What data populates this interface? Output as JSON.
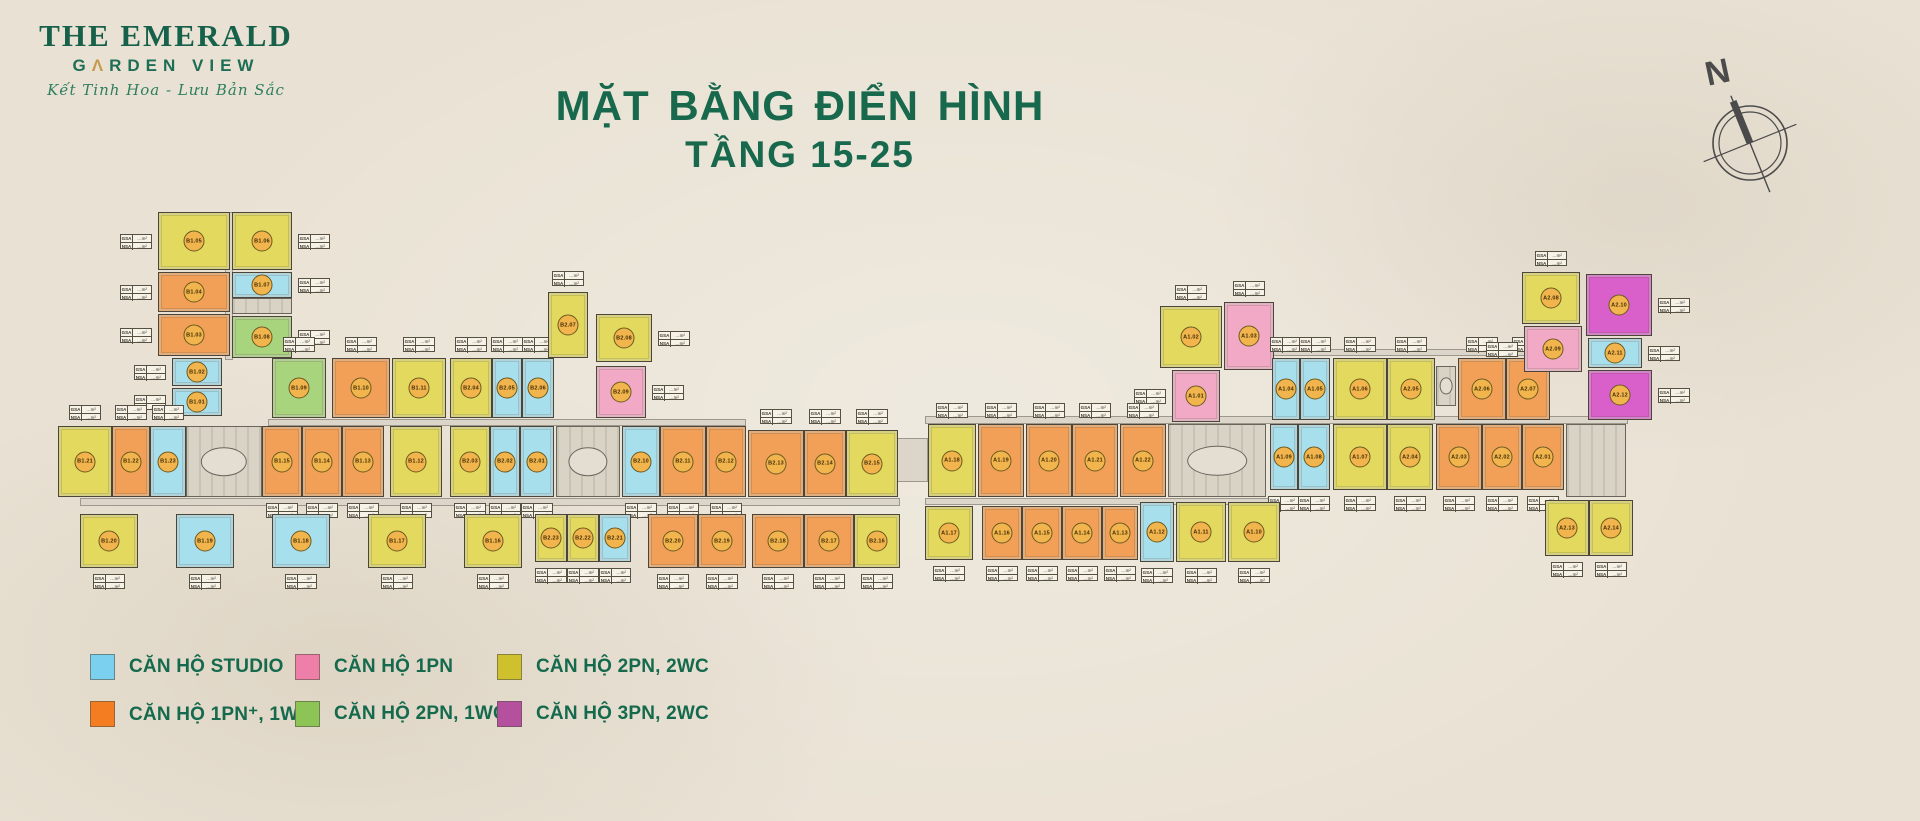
{
  "logo": {
    "line1": "THE EMERALD",
    "line2_prefix": "G",
    "line2_a": "Λ",
    "line2_suffix": "RDEN VIEW",
    "tagline": "Kết Tinh Hoa - Lưu Bản Sắc"
  },
  "title": {
    "line1": "MẶT BẰNG ĐIỂN HÌNH",
    "line2": "TẦNG 15-25"
  },
  "compass": {
    "label": "N"
  },
  "colors": {
    "studio": {
      "unit": "#a7dfed",
      "legend": "#7bd0ef"
    },
    "1pn": {
      "unit": "#f2a9c5",
      "legend": "#ee7fa9"
    },
    "2pn2wc": {
      "unit": "#e2d95e",
      "legend": "#cfc02d"
    },
    "1pn_plus": {
      "unit": "#f2a057",
      "legend": "#f47d21"
    },
    "2pn1wc": {
      "unit": "#a9d47e",
      "legend": "#8cc456"
    },
    "3pn2wc": {
      "unit": "#d95fcb",
      "legend": "#b4509e"
    },
    "accent_green": "#17684c",
    "accent_gold": "#c69b4e"
  },
  "legend": {
    "items": [
      {
        "label": "CĂN HỘ STUDIO",
        "type": "studio"
      },
      {
        "label": "CĂN HỘ 1PN",
        "type": "1pn"
      },
      {
        "label": "CĂN HỘ 2PN, 2WC",
        "type": "2pn2wc"
      },
      {
        "label": "CĂN HỘ 1PN⁺, 1WC",
        "type": "1pn_plus"
      },
      {
        "label": "CĂN HỘ 2PN, 1WC",
        "type": "2pn1wc"
      },
      {
        "label": "CĂN HỘ 3PN, 2WC",
        "type": "3pn2wc"
      }
    ],
    "cols_x": [
      90,
      295,
      497
    ],
    "rows_y": [
      654,
      701
    ]
  },
  "plan": {
    "table_labels": {
      "gsa": "GSA",
      "nsa": "NSA",
      "val": "…m²"
    },
    "corridors": [
      {
        "x": 225,
        "y": 212,
        "w": 8,
        "h": 148
      },
      {
        "x": 268,
        "y": 419,
        "w": 478,
        "h": 7
      },
      {
        "x": 80,
        "y": 498,
        "w": 820,
        "h": 8
      },
      {
        "x": 896,
        "y": 438,
        "w": 32,
        "h": 44
      },
      {
        "x": 925,
        "y": 416,
        "w": 703,
        "h": 8
      },
      {
        "x": 925,
        "y": 498,
        "w": 358,
        "h": 7
      },
      {
        "x": 1272,
        "y": 349,
        "w": 268,
        "h": 7
      }
    ],
    "cores": [
      {
        "x": 232,
        "y": 298,
        "w": 60,
        "h": 16,
        "oval": false
      },
      {
        "x": 186,
        "y": 426,
        "w": 76,
        "h": 71,
        "oval": true
      },
      {
        "x": 556,
        "y": 426,
        "w": 64,
        "h": 71,
        "oval": true
      },
      {
        "x": 1168,
        "y": 424,
        "w": 98,
        "h": 73,
        "oval": true
      },
      {
        "x": 1566,
        "y": 424,
        "w": 60,
        "h": 73,
        "oval": false
      },
      {
        "x": 1436,
        "y": 366,
        "w": 20,
        "h": 40,
        "oval": true
      }
    ],
    "clusters": [
      {
        "name": "block-B1-B2",
        "units": [
          {
            "code": "B1.05",
            "type": "2pn2wc",
            "x": 158,
            "y": 212,
            "w": 72,
            "h": 58,
            "tbl": "left"
          },
          {
            "code": "B1.06",
            "type": "2pn2wc",
            "x": 232,
            "y": 212,
            "w": 60,
            "h": 58,
            "tbl": "right"
          },
          {
            "code": "B1.04",
            "type": "1pn_plus",
            "x": 158,
            "y": 272,
            "w": 72,
            "h": 40,
            "tbl": "left"
          },
          {
            "code": "B1.07",
            "type": "studio",
            "x": 232,
            "y": 272,
            "w": 60,
            "h": 26,
            "tbl": "right"
          },
          {
            "code": "B1.03",
            "type": "1pn_plus",
            "x": 158,
            "y": 314,
            "w": 72,
            "h": 42,
            "tbl": "left"
          },
          {
            "code": "B1.08",
            "type": "2pn1wc",
            "x": 232,
            "y": 316,
            "w": 60,
            "h": 42,
            "tbl": "right"
          },
          {
            "code": "B1.02",
            "type": "studio",
            "x": 172,
            "y": 358,
            "w": 50,
            "h": 28,
            "tbl": "left"
          },
          {
            "code": "B1.01",
            "type": "studio",
            "x": 172,
            "y": 388,
            "w": 50,
            "h": 28,
            "tbl": "left"
          },
          {
            "code": "B1.09",
            "type": "2pn1wc",
            "x": 272,
            "y": 358,
            "w": 54,
            "h": 60,
            "tbl": "above"
          },
          {
            "code": "B1.10",
            "type": "1pn_plus",
            "x": 332,
            "y": 358,
            "w": 58,
            "h": 60,
            "tbl": "above"
          },
          {
            "code": "B1.11",
            "type": "2pn2wc",
            "x": 392,
            "y": 358,
            "w": 54,
            "h": 60,
            "tbl": "above"
          },
          {
            "code": "B2.04",
            "type": "2pn2wc",
            "x": 450,
            "y": 358,
            "w": 42,
            "h": 60,
            "tbl": "above"
          },
          {
            "code": "B2.05",
            "type": "studio",
            "x": 492,
            "y": 358,
            "w": 30,
            "h": 60,
            "tbl": "above"
          },
          {
            "code": "B2.06",
            "type": "studio",
            "x": 522,
            "y": 358,
            "w": 32,
            "h": 60,
            "tbl": "above"
          },
          {
            "code": "B2.07",
            "type": "2pn2wc",
            "x": 548,
            "y": 292,
            "w": 40,
            "h": 66,
            "tbl": "above"
          },
          {
            "code": "B2.08",
            "type": "2pn2wc",
            "x": 596,
            "y": 314,
            "w": 56,
            "h": 48,
            "tbl": "right"
          },
          {
            "code": "B2.09",
            "type": "1pn",
            "x": 596,
            "y": 366,
            "w": 50,
            "h": 52,
            "tbl": "right"
          },
          {
            "code": "B1.21",
            "type": "2pn2wc",
            "x": 58,
            "y": 426,
            "w": 54,
            "h": 71,
            "tbl": "above"
          },
          {
            "code": "B1.22",
            "type": "1pn_plus",
            "x": 112,
            "y": 426,
            "w": 38,
            "h": 71,
            "tbl": "above"
          },
          {
            "code": "B1.23",
            "type": "studio",
            "x": 150,
            "y": 426,
            "w": 36,
            "h": 71,
            "tbl": "above"
          },
          {
            "code": "B1.15",
            "type": "1pn_plus",
            "x": 262,
            "y": 426,
            "w": 40,
            "h": 71,
            "tbl": "below"
          },
          {
            "code": "B1.14",
            "type": "1pn_plus",
            "x": 302,
            "y": 426,
            "w": 40,
            "h": 71,
            "tbl": "below"
          },
          {
            "code": "B1.13",
            "type": "1pn_plus",
            "x": 342,
            "y": 426,
            "w": 42,
            "h": 71,
            "tbl": "below"
          },
          {
            "code": "B1.12",
            "type": "2pn2wc",
            "x": 390,
            "y": 426,
            "w": 52,
            "h": 71,
            "tbl": "below"
          },
          {
            "code": "B2.03",
            "type": "2pn2wc",
            "x": 450,
            "y": 426,
            "w": 40,
            "h": 71,
            "tbl": "below"
          },
          {
            "code": "B2.02",
            "type": "studio",
            "x": 490,
            "y": 426,
            "w": 30,
            "h": 71,
            "tbl": "below"
          },
          {
            "code": "B2.01",
            "type": "studio",
            "x": 520,
            "y": 426,
            "w": 34,
            "h": 71,
            "tbl": "below"
          },
          {
            "code": "B2.10",
            "type": "studio",
            "x": 622,
            "y": 426,
            "w": 38,
            "h": 71,
            "tbl": "below"
          },
          {
            "code": "B2.11",
            "type": "1pn_plus",
            "x": 660,
            "y": 426,
            "w": 46,
            "h": 71,
            "tbl": "below"
          },
          {
            "code": "B2.12",
            "type": "1pn_plus",
            "x": 706,
            "y": 426,
            "w": 40,
            "h": 71,
            "tbl": "below"
          },
          {
            "code": "B2.13",
            "type": "1pn_plus",
            "x": 748,
            "y": 430,
            "w": 56,
            "h": 67,
            "tbl": "above"
          },
          {
            "code": "B2.14",
            "type": "1pn_plus",
            "x": 804,
            "y": 430,
            "w": 42,
            "h": 67,
            "tbl": "above"
          },
          {
            "code": "B2.15",
            "type": "2pn2wc",
            "x": 846,
            "y": 430,
            "w": 52,
            "h": 67,
            "tbl": "above"
          },
          {
            "code": "B1.20",
            "type": "2pn2wc",
            "x": 80,
            "y": 514,
            "w": 58,
            "h": 54,
            "tbl": "below"
          },
          {
            "code": "B1.19",
            "type": "studio",
            "x": 176,
            "y": 514,
            "w": 58,
            "h": 54,
            "tbl": "below"
          },
          {
            "code": "B1.18",
            "type": "studio",
            "x": 272,
            "y": 514,
            "w": 58,
            "h": 54,
            "tbl": "below"
          },
          {
            "code": "B1.17",
            "type": "2pn2wc",
            "x": 368,
            "y": 514,
            "w": 58,
            "h": 54,
            "tbl": "below"
          },
          {
            "code": "B1.16",
            "type": "2pn2wc",
            "x": 464,
            "y": 514,
            "w": 58,
            "h": 54,
            "tbl": "below"
          },
          {
            "code": "B2.23",
            "type": "2pn2wc",
            "x": 535,
            "y": 514,
            "w": 32,
            "h": 48,
            "tbl": "below"
          },
          {
            "code": "B2.22",
            "type": "2pn2wc",
            "x": 567,
            "y": 514,
            "w": 32,
            "h": 48,
            "tbl": "below"
          },
          {
            "code": "B2.21",
            "type": "studio",
            "x": 599,
            "y": 514,
            "w": 32,
            "h": 48,
            "tbl": "below"
          },
          {
            "code": "B2.20",
            "type": "1pn_plus",
            "x": 648,
            "y": 514,
            "w": 50,
            "h": 54,
            "tbl": "below"
          },
          {
            "code": "B2.19",
            "type": "1pn_plus",
            "x": 698,
            "y": 514,
            "w": 48,
            "h": 54,
            "tbl": "below"
          },
          {
            "code": "B2.18",
            "type": "1pn_plus",
            "x": 752,
            "y": 514,
            "w": 52,
            "h": 54,
            "tbl": "below"
          },
          {
            "code": "B2.17",
            "type": "1pn_plus",
            "x": 804,
            "y": 514,
            "w": 50,
            "h": 54,
            "tbl": "below"
          },
          {
            "code": "B2.16",
            "type": "2pn2wc",
            "x": 854,
            "y": 514,
            "w": 46,
            "h": 54,
            "tbl": "below"
          }
        ]
      },
      {
        "name": "block-A1-A2",
        "units": [
          {
            "code": "A1.02",
            "type": "2pn2wc",
            "x": 1160,
            "y": 306,
            "w": 62,
            "h": 62,
            "tbl": "above"
          },
          {
            "code": "A1.03",
            "type": "1pn",
            "x": 1224,
            "y": 302,
            "w": 50,
            "h": 68,
            "tbl": "above"
          },
          {
            "code": "A1.01",
            "type": "1pn",
            "x": 1172,
            "y": 370,
            "w": 48,
            "h": 52,
            "tbl": "left"
          },
          {
            "code": "A1.04",
            "type": "studio",
            "x": 1272,
            "y": 358,
            "w": 28,
            "h": 62,
            "tbl": "above"
          },
          {
            "code": "A1.05",
            "type": "studio",
            "x": 1300,
            "y": 358,
            "w": 30,
            "h": 62,
            "tbl": "above"
          },
          {
            "code": "A1.06",
            "type": "2pn2wc",
            "x": 1333,
            "y": 358,
            "w": 54,
            "h": 62,
            "tbl": "above"
          },
          {
            "code": "A2.05",
            "type": "2pn2wc",
            "x": 1387,
            "y": 358,
            "w": 48,
            "h": 62,
            "tbl": "above"
          },
          {
            "code": "A2.06",
            "type": "1pn_plus",
            "x": 1458,
            "y": 358,
            "w": 48,
            "h": 62,
            "tbl": "above"
          },
          {
            "code": "A2.07",
            "type": "1pn_plus",
            "x": 1506,
            "y": 358,
            "w": 44,
            "h": 62,
            "tbl": "above"
          },
          {
            "code": "A2.08",
            "type": "2pn2wc",
            "x": 1522,
            "y": 272,
            "w": 58,
            "h": 52,
            "tbl": "above"
          },
          {
            "code": "A2.09",
            "type": "1pn",
            "x": 1524,
            "y": 326,
            "w": 58,
            "h": 46,
            "tbl": "left"
          },
          {
            "code": "A2.10",
            "type": "3pn2wc",
            "x": 1586,
            "y": 274,
            "w": 66,
            "h": 62,
            "tbl": "right"
          },
          {
            "code": "A2.11",
            "type": "studio",
            "x": 1588,
            "y": 338,
            "w": 54,
            "h": 30,
            "tbl": "right"
          },
          {
            "code": "A2.12",
            "type": "3pn2wc",
            "x": 1588,
            "y": 370,
            "w": 64,
            "h": 50,
            "tbl": "right"
          },
          {
            "code": "A1.18",
            "type": "2pn2wc",
            "x": 928,
            "y": 424,
            "w": 48,
            "h": 73,
            "tbl": "above"
          },
          {
            "code": "A1.19",
            "type": "1pn_plus",
            "x": 978,
            "y": 424,
            "w": 46,
            "h": 73,
            "tbl": "above"
          },
          {
            "code": "A1.20",
            "type": "1pn_plus",
            "x": 1026,
            "y": 424,
            "w": 46,
            "h": 73,
            "tbl": "above"
          },
          {
            "code": "A1.21",
            "type": "1pn_plus",
            "x": 1072,
            "y": 424,
            "w": 46,
            "h": 73,
            "tbl": "above"
          },
          {
            "code": "A1.22",
            "type": "1pn_plus",
            "x": 1120,
            "y": 424,
            "w": 46,
            "h": 73,
            "tbl": "above"
          },
          {
            "code": "A1.09",
            "type": "studio",
            "x": 1270,
            "y": 424,
            "w": 28,
            "h": 66,
            "tbl": "below"
          },
          {
            "code": "A1.08",
            "type": "studio",
            "x": 1298,
            "y": 424,
            "w": 32,
            "h": 66,
            "tbl": "below"
          },
          {
            "code": "A1.07",
            "type": "2pn2wc",
            "x": 1333,
            "y": 424,
            "w": 54,
            "h": 66,
            "tbl": "below"
          },
          {
            "code": "A2.04",
            "type": "2pn2wc",
            "x": 1387,
            "y": 424,
            "w": 46,
            "h": 66,
            "tbl": "below"
          },
          {
            "code": "A2.03",
            "type": "1pn_plus",
            "x": 1436,
            "y": 424,
            "w": 46,
            "h": 66,
            "tbl": "below"
          },
          {
            "code": "A2.02",
            "type": "1pn_plus",
            "x": 1482,
            "y": 424,
            "w": 40,
            "h": 66,
            "tbl": "below"
          },
          {
            "code": "A2.01",
            "type": "1pn_plus",
            "x": 1522,
            "y": 424,
            "w": 42,
            "h": 66,
            "tbl": "below"
          },
          {
            "code": "A1.17",
            "type": "2pn2wc",
            "x": 925,
            "y": 506,
            "w": 48,
            "h": 54,
            "tbl": "below"
          },
          {
            "code": "A1.16",
            "type": "1pn_plus",
            "x": 982,
            "y": 506,
            "w": 40,
            "h": 54,
            "tbl": "below"
          },
          {
            "code": "A1.15",
            "type": "1pn_plus",
            "x": 1022,
            "y": 506,
            "w": 40,
            "h": 54,
            "tbl": "below"
          },
          {
            "code": "A1.14",
            "type": "1pn_plus",
            "x": 1062,
            "y": 506,
            "w": 40,
            "h": 54,
            "tbl": "below"
          },
          {
            "code": "A1.13",
            "type": "1pn_plus",
            "x": 1102,
            "y": 506,
            "w": 36,
            "h": 54,
            "tbl": "below"
          },
          {
            "code": "A1.12",
            "type": "studio",
            "x": 1140,
            "y": 502,
            "w": 34,
            "h": 60,
            "tbl": "below"
          },
          {
            "code": "A1.11",
            "type": "2pn2wc",
            "x": 1176,
            "y": 502,
            "w": 50,
            "h": 60,
            "tbl": "below"
          },
          {
            "code": "A1.10",
            "type": "2pn2wc",
            "x": 1228,
            "y": 502,
            "w": 52,
            "h": 60,
            "tbl": "below"
          },
          {
            "code": "A2.13",
            "type": "2pn2wc",
            "x": 1545,
            "y": 500,
            "w": 44,
            "h": 56,
            "tbl": "below"
          },
          {
            "code": "A2.14",
            "type": "2pn2wc",
            "x": 1589,
            "y": 500,
            "w": 44,
            "h": 56,
            "tbl": "below"
          }
        ]
      }
    ]
  }
}
